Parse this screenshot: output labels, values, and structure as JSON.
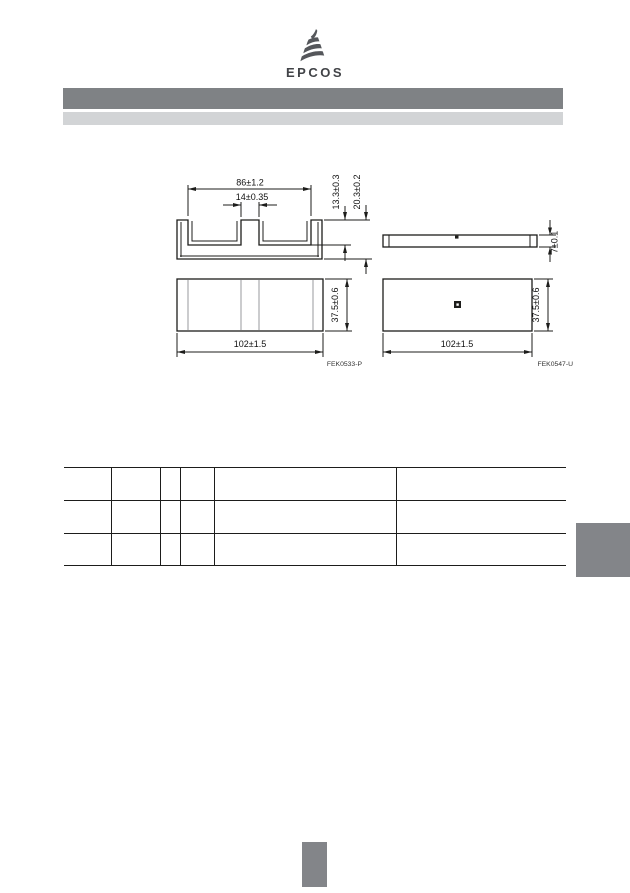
{
  "logo": {
    "text": "EPCOS",
    "icon_color": "#55575b",
    "text_color": "#414347"
  },
  "header": {
    "bar_dark_color": "#7f8285",
    "bar_light_color": "#d2d4d6"
  },
  "drawings": {
    "core": {
      "label": "FEK0533-P",
      "top_width": "86±1.2",
      "center_leg": "14±0.35",
      "window_depth": "13.3±0.3",
      "height": "20.3±0.2",
      "depth": "37.5±0.6",
      "length": "102±1.5"
    },
    "plate": {
      "label": "FEK0547-U",
      "thickness": "7±0.1",
      "depth": "37.5±0.6",
      "length": "102±1.5"
    }
  },
  "table": {
    "rows": 3,
    "columns": 6
  },
  "markers": {
    "tab_color": "#838589",
    "block_color": "#838589"
  }
}
